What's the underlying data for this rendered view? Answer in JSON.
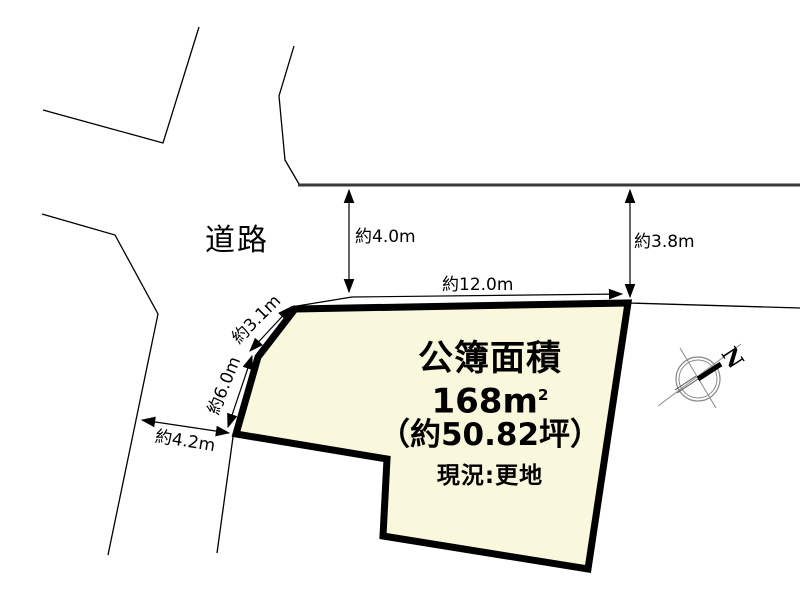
{
  "diagram": {
    "road_label": "道路",
    "north_label": "N"
  },
  "dimensions": {
    "road_width_upper_left": "約4.0m",
    "road_width_upper_right": "約3.8m",
    "frontage_top": "約12.0m",
    "edge_upper_left": "約3.1m",
    "edge_left": "約6.0m",
    "road_width_lower_left": "約4.2m"
  },
  "parcel": {
    "area_title": "公簿面積",
    "area_number": "168",
    "area_unit": "m",
    "area_exponent": "2",
    "area_tsubo": "（約50.82坪）",
    "current_status": "現況:更地"
  },
  "colors": {
    "parcel_fill": "#F9F7DC",
    "parcel_outline": "#000000",
    "road_line_dark": "#3A3A3A",
    "thin_line": "#000000",
    "compass_line": "#8A8A8A"
  }
}
